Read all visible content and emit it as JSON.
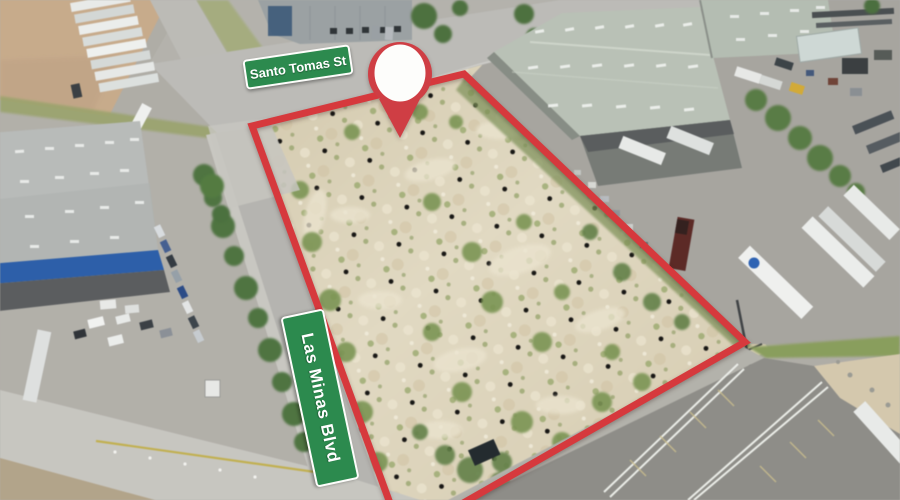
{
  "annotations": {
    "street_signs": [
      {
        "label": "Santo Tomas St",
        "sign_color": "#2c8a4e"
      },
      {
        "label": "Las Minas Blvd",
        "sign_color": "#2c8a4e"
      }
    ],
    "marker": {
      "icon": "location-pin-icon",
      "pin_color": "#cf3e44",
      "inner_color": "#fdfdfb"
    },
    "parcel_boundary": {
      "color": "#d6393d"
    }
  }
}
